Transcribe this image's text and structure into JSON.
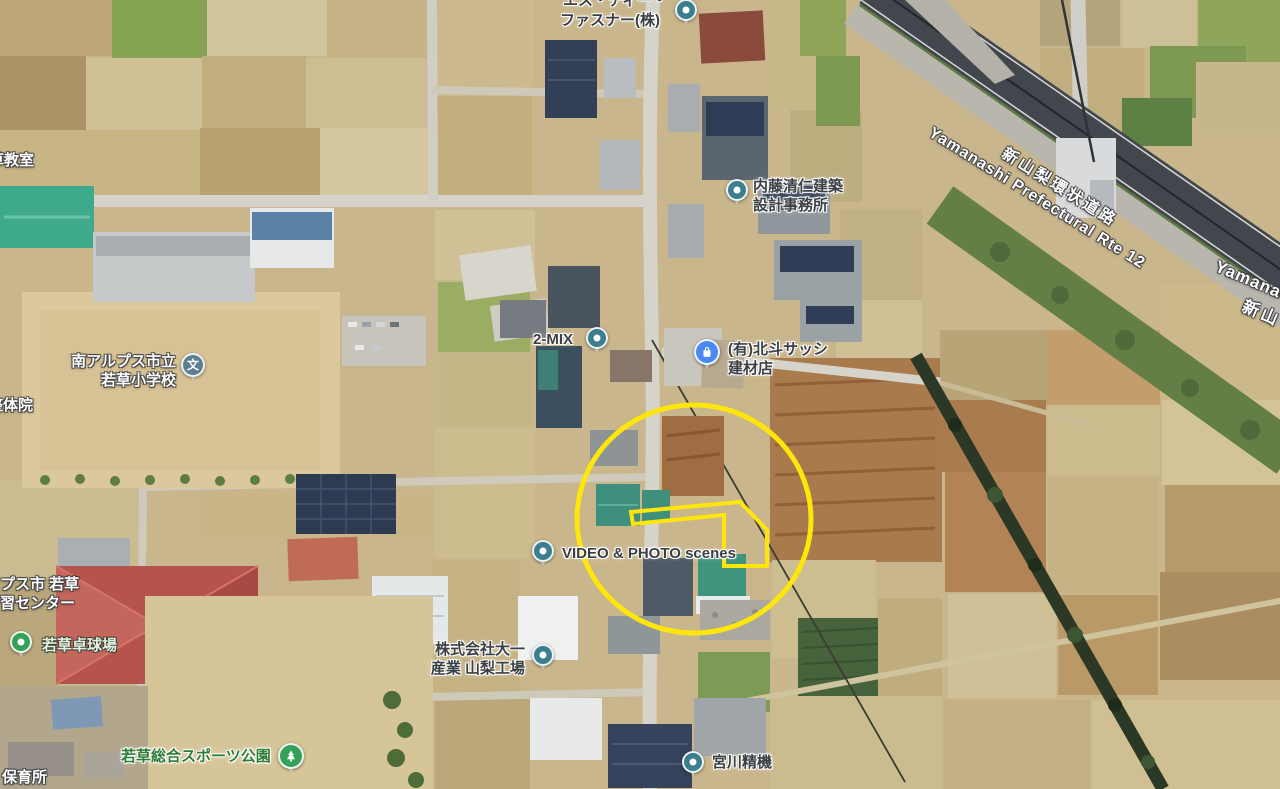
{
  "app": {
    "name": "satellite-map-view"
  },
  "road_labels": {
    "ring_road_jp": "新山梨環状道路",
    "ring_road_en": "Yamanashi Prefectural Rte 12",
    "ring_road_en_edge": "Yamana",
    "ring_road_jp_edge": "新山"
  },
  "pois": {
    "sd_fastener": {
      "line1": "エス・ディー・",
      "line2": "ファスナー(株)"
    },
    "naito_architect": {
      "line1": "内藤清仁建築",
      "line2": "設計事務所"
    },
    "two_mix": {
      "label": "2-MIX"
    },
    "hokuto_sash": {
      "line1": "(有)北斗サッシ",
      "line2": "建材店"
    },
    "wakakusa_elementary": {
      "line1": "南アルプス市立",
      "line2": "若草小学校",
      "symbol": "文"
    },
    "kusa_classroom": {
      "label": "草教室"
    },
    "seitai_clinic": {
      "label": "整体院"
    },
    "gakushu_center": {
      "line1": "プス市 若草",
      "line2": "習センター"
    },
    "wakakusa_table_tennis": {
      "label": "若草卓球場"
    },
    "video_photo_scenes": {
      "label": "VIDEO & PHOTO scenes"
    },
    "daiichi_sangyo": {
      "line1": "株式会社大一",
      "line2": "産業 山梨工場"
    },
    "wakakusa_sports_park": {
      "label": "若草総合スポーツ公園"
    },
    "nursery": {
      "label": "保育所"
    },
    "miyagawa_seiki": {
      "label": "宮川精機"
    }
  },
  "annotation": {
    "highlight_color": "#FFE60A",
    "shapes": [
      "circle",
      "parcel-outline"
    ]
  },
  "marker_colors": {
    "default": "#3B7F8F",
    "store": "#4A88F2",
    "school": "#5E808E",
    "park": "#34A05A"
  }
}
